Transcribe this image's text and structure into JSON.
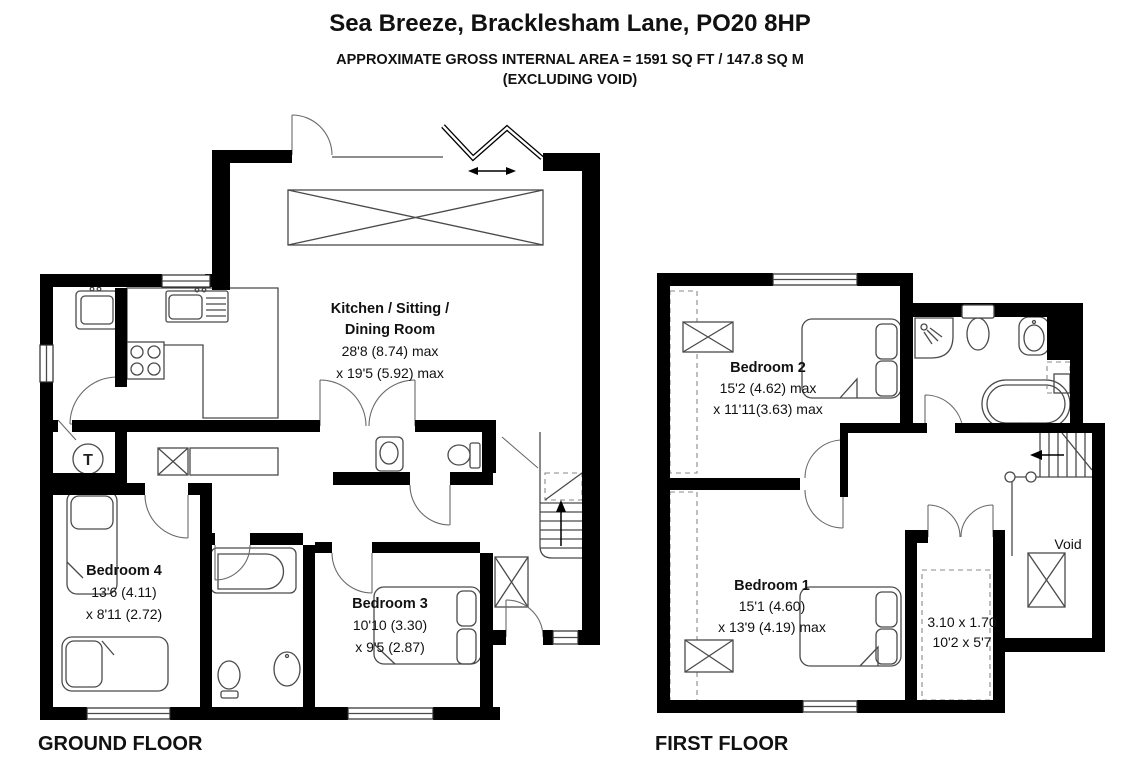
{
  "header": {
    "title": "Sea Breeze, Bracklesham Lane, PO20 8HP",
    "area_line1": "APPROXIMATE GROSS INTERNAL AREA = 1591 SQ FT / 147.8 SQ M",
    "area_line2": "(EXCLUDING VOID)"
  },
  "ground_floor": {
    "label": "GROUND FLOOR",
    "rooms": {
      "kitchen": {
        "name_line1": "Kitchen / Sitting /",
        "name_line2": "Dining Room",
        "dims_line1": "28'8 (8.74) max",
        "dims_line2": "x 19'5 (5.92) max"
      },
      "bedroom4": {
        "name": "Bedroom 4",
        "dims_line1": "13'6 (4.11)",
        "dims_line2": "x 8'11 (2.72)"
      },
      "bedroom3": {
        "name": "Bedroom 3",
        "dims_line1": "10'10 (3.30)",
        "dims_line2": "x 9'5 (2.87)"
      }
    },
    "symbols": {
      "tank": "T"
    }
  },
  "first_floor": {
    "label": "FIRST FLOOR",
    "rooms": {
      "bedroom2": {
        "name": "Bedroom 2",
        "dims_line1": "15'2 (4.62) max",
        "dims_line2": "x 11'11(3.63) max"
      },
      "bedroom1": {
        "name": "Bedroom 1",
        "dims_line1": "15'1 (4.60)",
        "dims_line2": "x 13'9 (4.19) max"
      },
      "eaves_storage": {
        "dims_line1": "3.10 x 1.70",
        "dims_line2": "10'2 x 5'7"
      },
      "void": {
        "label": "Void"
      }
    }
  },
  "colors": {
    "wall": "#000000",
    "fixture_line": "#4a4a4a",
    "text": "#111111",
    "background": "#ffffff"
  }
}
